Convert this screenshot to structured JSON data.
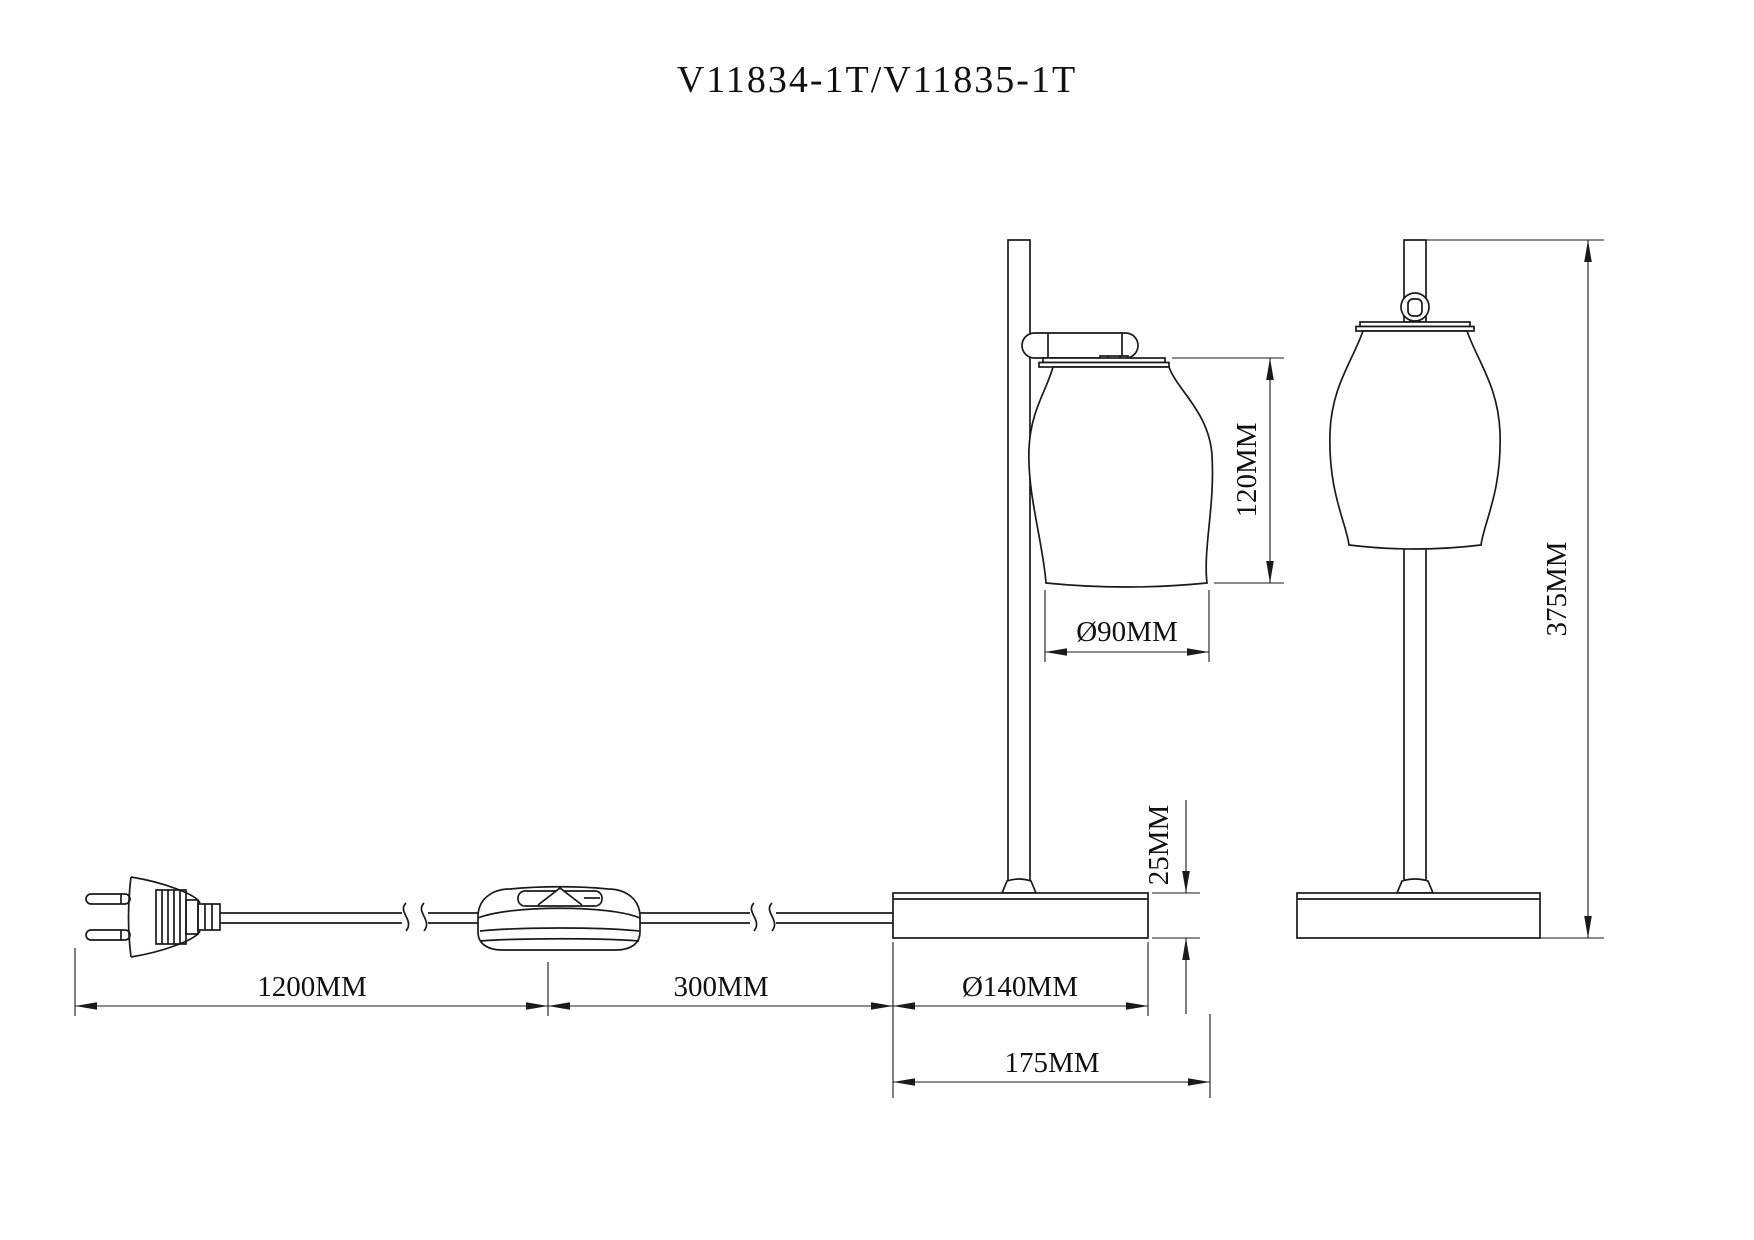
{
  "title": "V11834-1T/V11835-1T",
  "drawing_type": "table-lamp-dimension-drawing",
  "dimensions": {
    "cord_length": "1200MM",
    "switch_section": "300MM",
    "base_diameter": "Ø140MM",
    "base_overall_width": "175MM",
    "base_height": "25MM",
    "shade_height": "120MM",
    "shade_diameter": "Ø90MM",
    "total_height": "375MM"
  },
  "colors": {
    "line": "#1a1a1a",
    "background": "#ffffff"
  }
}
